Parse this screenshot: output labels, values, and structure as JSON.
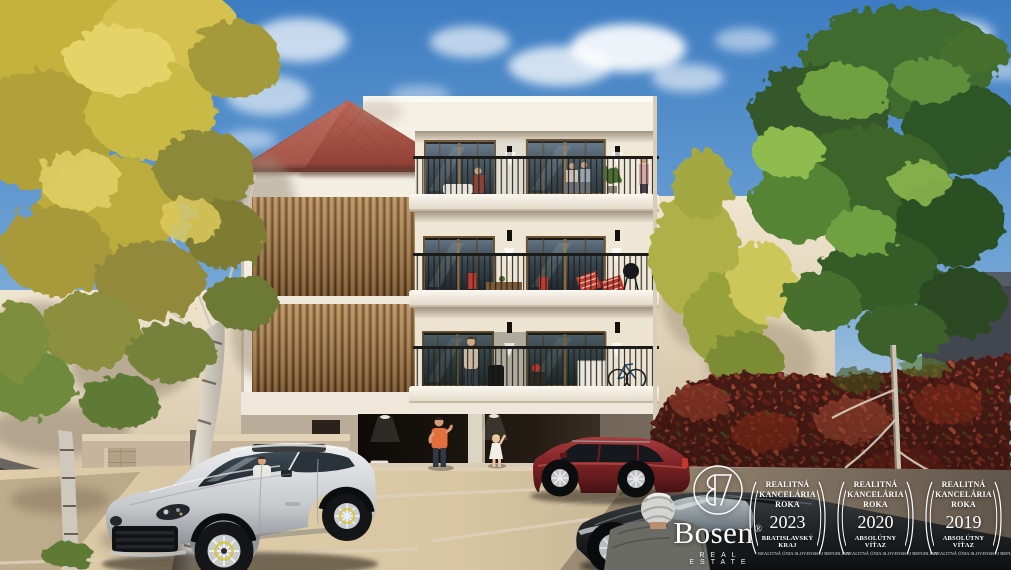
{
  "watermark": {
    "logo": {
      "name": "Bosen",
      "registered_mark": "®",
      "tagline": "REAL ESTATE",
      "monogram_icon": "bosen-monogram-icon"
    },
    "badges": [
      {
        "title_line1": "REALITNÁ",
        "title_line2": "KANCELÁRIA",
        "title_line3": "ROKA",
        "year": "2023",
        "award": "BRATISLAVSKÝ KRAJ",
        "organization": "REALITNÁ ÚNIA SLOVENSKEJ REPUBLIKY"
      },
      {
        "title_line1": "REALITNÁ",
        "title_line2": "KANCELÁRIA",
        "title_line3": "ROKA",
        "year": "2020",
        "award": "ABSOLÚTNY VÍŤAZ",
        "organization": "REALITNÁ ÚNIA SLOVENSKEJ REPUBLIKY"
      },
      {
        "title_line1": "REALITNÁ",
        "title_line2": "KANCELÁRIA",
        "title_line3": "ROKA",
        "year": "2019",
        "award": "ABSOLÚTNY VÍŤAZ",
        "organization": "REALITNÁ ÚNIA SLOVENSKEJ REPUBLIKY"
      }
    ]
  },
  "scene": {
    "colors": {
      "sky_top": "#3d7cc2",
      "sky_horizon": "#c6d8e5",
      "roof_tiles": "#b05a4e",
      "facade_white": "#f3eee2",
      "wood_slats": "#b3834e",
      "balcony_glass": "#3a4750",
      "ivy_wall": "#7c2f20",
      "foliage_yellow": "#cdbb4a",
      "foliage_green": "#4f7c33",
      "pavement": "#cfbb9a",
      "car_silver": "#d4d6d8",
      "car_red": "#8e2a2c",
      "car_dark": "#232527"
    }
  }
}
